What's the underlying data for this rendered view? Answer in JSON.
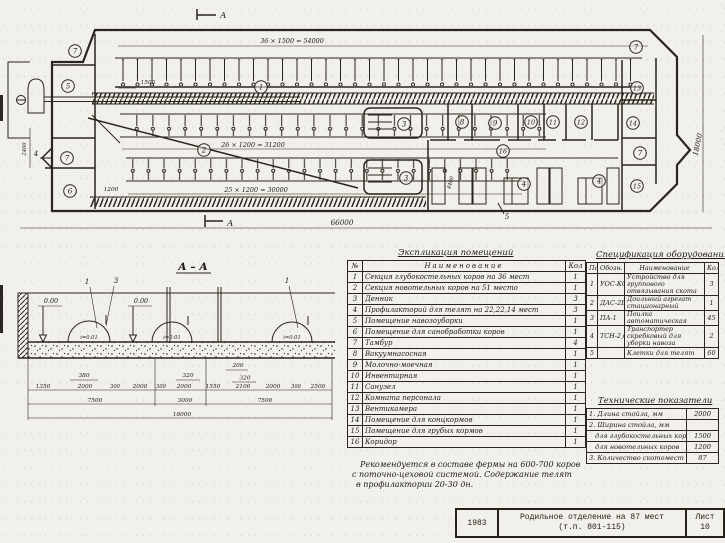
{
  "drawing": {
    "plan": {
      "marker_a": "А",
      "dim_top": "36 × 1500 = 54000",
      "dim_1500": "1500",
      "dim_row2": "26 × 1200 = 31200",
      "dim_row3": "25 × 1200 = 30000",
      "dim_1200": "1200",
      "dim_overall": "66000",
      "dim_right": "18000",
      "dim_left": "2400",
      "dim_4400": "4400",
      "marker_4": "4",
      "marker_5": "5",
      "labels": [
        "7",
        "5",
        "7",
        "6",
        "1",
        "2",
        "3",
        "3",
        "8",
        "9",
        "10",
        "11",
        "12",
        "16",
        "13",
        "14",
        "7",
        "15",
        "4",
        "4",
        "7"
      ]
    },
    "section": {
      "title": "А – А",
      "level": "0.00",
      "slope": "i=0.01",
      "markers": [
        "1",
        "3",
        "1"
      ],
      "small_dims": [
        "380",
        "320",
        "200",
        "320"
      ],
      "chain_dims": [
        "1350",
        "2000",
        "300",
        "2000",
        "300",
        "2000",
        "1550",
        "2100",
        "2000",
        "300",
        "2500"
      ],
      "group_dims": [
        "7500",
        "3000",
        "7500"
      ],
      "overall_dim": "18000"
    }
  },
  "explication": {
    "title": "Экспликация помещений",
    "headers": {
      "no": "№",
      "name": "Наименование",
      "qty": "Кол"
    },
    "rows": [
      {
        "no": "1",
        "name": "Секция глубокостельных коров на 36 мест",
        "qty": "1"
      },
      {
        "no": "2",
        "name": "Секция новотельных коров на 51 место",
        "qty": "1"
      },
      {
        "no": "3",
        "name": "Денник",
        "qty": "3"
      },
      {
        "no": "4",
        "name": "Профилакторий для телят на 22,22,14 мест",
        "qty": "3"
      },
      {
        "no": "5",
        "name": "Помещение навозоуборки",
        "qty": "1"
      },
      {
        "no": "6",
        "name": "Помещение для санобработки коров",
        "qty": "1"
      },
      {
        "no": "7",
        "name": "Тамбур",
        "qty": "4"
      },
      {
        "no": "8",
        "name": "Вакуумнасосная",
        "qty": "1"
      },
      {
        "no": "9",
        "name": "Молочно-моечная",
        "qty": "1"
      },
      {
        "no": "10",
        "name": "Инвентарная",
        "qty": "1"
      },
      {
        "no": "11",
        "name": "Санузел",
        "qty": "1"
      },
      {
        "no": "12",
        "name": "Комната персонала",
        "qty": "1"
      },
      {
        "no": "13",
        "name": "Вентикамера",
        "qty": "1"
      },
      {
        "no": "14",
        "name": "Помещение для концкормов",
        "qty": "1"
      },
      {
        "no": "15",
        "name": "Помещение для грубых кормов",
        "qty": "1"
      },
      {
        "no": "16",
        "name": "Коридор",
        "qty": "1"
      }
    ]
  },
  "equipment": {
    "title": "Спецификация оборудования",
    "headers": {
      "pos": "Поз",
      "mark": "Обозн.",
      "name": "Наименование",
      "qty": "Кол"
    },
    "rows": [
      {
        "pos": "1",
        "mark": "УОС-КО",
        "name": "Устройство для группового отвязывания скота",
        "qty": "3"
      },
      {
        "pos": "2",
        "mark": "ДАС-2Б",
        "name": "Доильный агрегат стационарный",
        "qty": "1"
      },
      {
        "pos": "3",
        "mark": "ПА-1",
        "name": "Поилка автоматическая",
        "qty": "45"
      },
      {
        "pos": "4",
        "mark": "ТСН-2,0Б",
        "name": "Транспортер скребковый для уборки навоза",
        "qty": "2"
      },
      {
        "pos": "5",
        "mark": "",
        "name": "Клетки для телят",
        "qty": "60"
      }
    ]
  },
  "tech": {
    "title": "Технические показатели",
    "rows": [
      {
        "name": "1. Длина стойла, мм",
        "value": "2000"
      },
      {
        "name": "2. Ширина стойла, мм",
        "value": ""
      },
      {
        "name": "для глубокостельных коров",
        "value": "1500"
      },
      {
        "name": "для новотельных коров",
        "value": "1200"
      },
      {
        "name": "3. Количество скотомест",
        "value": "87"
      }
    ]
  },
  "note": {
    "line1": "Рекомендуется в составе фермы на 600-700 коров",
    "line2": "с поточно-цеховой системой. Содержание телят",
    "line3": "в профилактории 20-30 дн."
  },
  "title_block": {
    "year": "1983",
    "line1": "Родильное отделение на 87 мест",
    "line2": "(т.п. 801-115)",
    "sheet_label": "Лист",
    "sheet_no": "10"
  }
}
